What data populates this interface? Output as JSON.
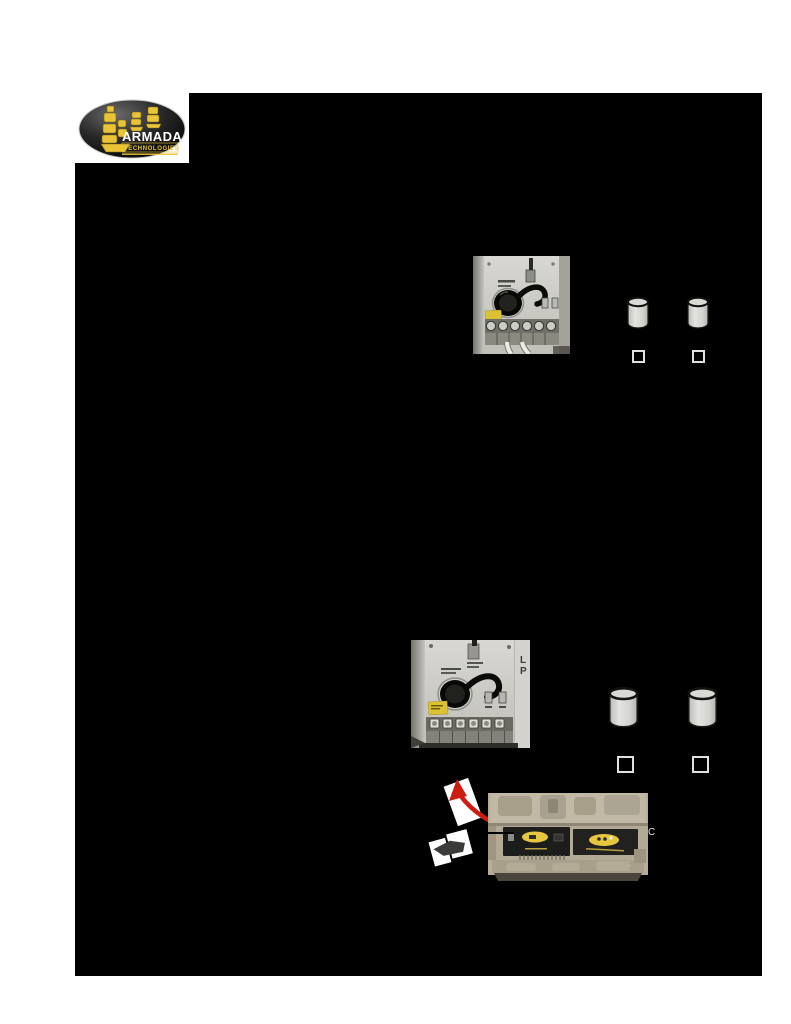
{
  "logo": {
    "brand": "ARMADA",
    "subtitle": "TECHNOLOGIES"
  },
  "captions": {
    "photo2_line1": "L",
    "photo2_line2": "P",
    "case_line1": "C"
  },
  "figures": {
    "photo1": "transformer-terminal-block-with-wires",
    "photo2": "transformer-module-panel",
    "photo3": "tracer-kit-carry-case",
    "checkbox_count": 4,
    "cylinder_count": 4
  },
  "colors": {
    "blackout_black": "#000000",
    "page_white": "#ffffff",
    "brand_yellow": "#e9c436",
    "arrow_red": "#cd1d12",
    "panel_gray": "#cfcec9",
    "case_tan": "#b5ac97",
    "label_yellow": "#dcc133",
    "cylinder_gray": "#d6d6d3"
  }
}
